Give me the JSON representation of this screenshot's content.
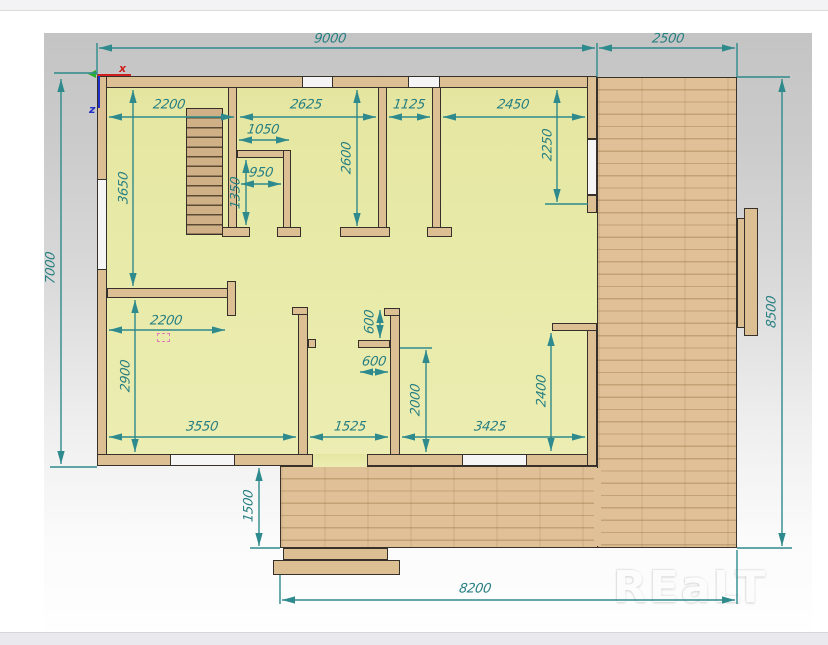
{
  "plan": {
    "watermark": "REaLT",
    "axis_labels": {
      "x": "x",
      "z": "z"
    },
    "dims": {
      "d9000": "9000",
      "d2500": "2500",
      "d7000": "7000",
      "d8500": "8500",
      "d8200": "8200",
      "d1500": "1500",
      "d2200_top": "2200",
      "d2625": "2625",
      "d1125": "1125",
      "d2450": "2450",
      "d1050": "1050",
      "d950": "950",
      "d1350": "1350",
      "d3650": "3650",
      "d2600": "2600",
      "d2250": "2250",
      "d2200_mid": "2200",
      "d2900": "2900",
      "d3550": "3550",
      "d1525": "1525",
      "d3425": "3425",
      "d600_vert": "600",
      "d600_horiz": "600",
      "d2000": "2000",
      "d2400": "2400"
    },
    "colors": {
      "dimension_teal": "#2e8a8c",
      "wall_tan": "#dcc094",
      "floor_yellow": "#e8eaa8",
      "deck_wood": "#e0c197",
      "outline_dark": "#35302a",
      "axis_x_red": "#cf2020",
      "axis_z_blue": "#2330c8"
    }
  }
}
